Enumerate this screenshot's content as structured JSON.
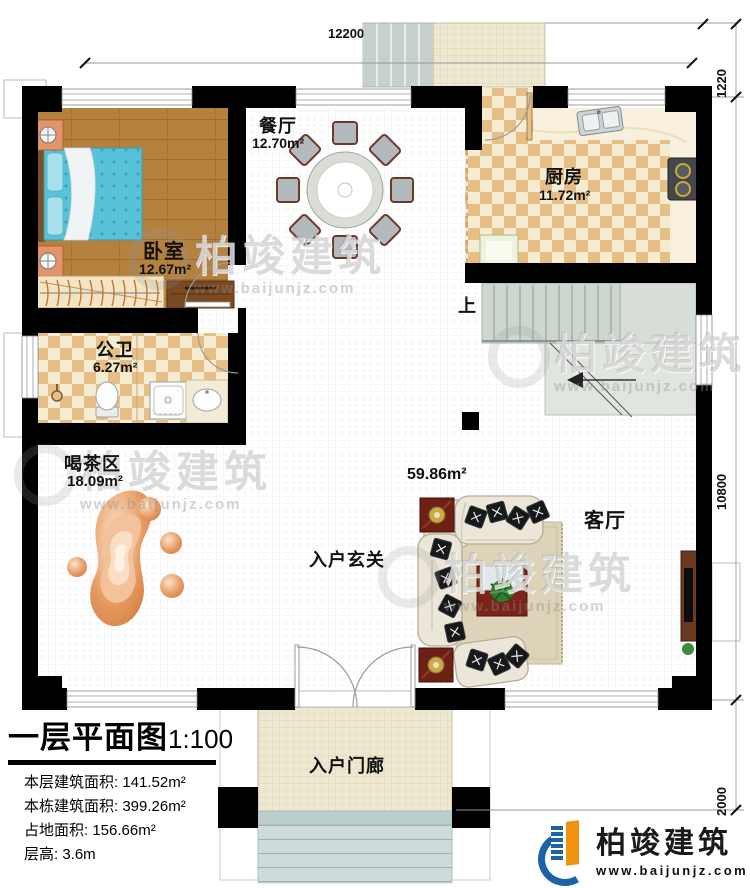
{
  "plan": {
    "drawing_title": "一层平面图",
    "drawing_scale": "1:100"
  },
  "rooms": {
    "bedroom": {
      "name": "卧室",
      "area": "12.67m²"
    },
    "dining": {
      "name": "餐厅",
      "area": "12.70m²"
    },
    "kitchen": {
      "name": "厨房",
      "area": "11.72m²"
    },
    "bathroom": {
      "name": "公卫",
      "area": "6.27m²"
    },
    "tea_area": {
      "name": "喝茶区",
      "area": "18.09m²"
    },
    "living": {
      "name": "客厅",
      "area": "59.86m²"
    },
    "foyer": {
      "name": "入户玄关"
    },
    "porch": {
      "name": "入户门廊"
    },
    "stairs": {
      "up_label": "上"
    }
  },
  "dimensions": {
    "top_width": "12200",
    "right_top": "1220",
    "right_side": "10800",
    "right_bottom": "2000"
  },
  "title_block": {
    "title": "一层平面图",
    "scale": "1:100",
    "lines": [
      "本层建筑面积: 141.52m²",
      "本栋建筑面积: 399.26m²",
      "占地面积: 156.66m²",
      "层高: 3.6m"
    ]
  },
  "branding": {
    "company": "柏竣建筑",
    "website": "www.baijunjz.com"
  },
  "watermark": {
    "text": "柏竣建筑",
    "website": "www.baijunjz.com"
  },
  "colors": {
    "wall": "#000000",
    "wood_floor": "#b5813f",
    "checker_tan": "#e5bf85",
    "stairs": "#cdd6cf",
    "stone": "#e2955e",
    "brand_blue": "#1a63a8",
    "brand_orange": "#f29211"
  }
}
